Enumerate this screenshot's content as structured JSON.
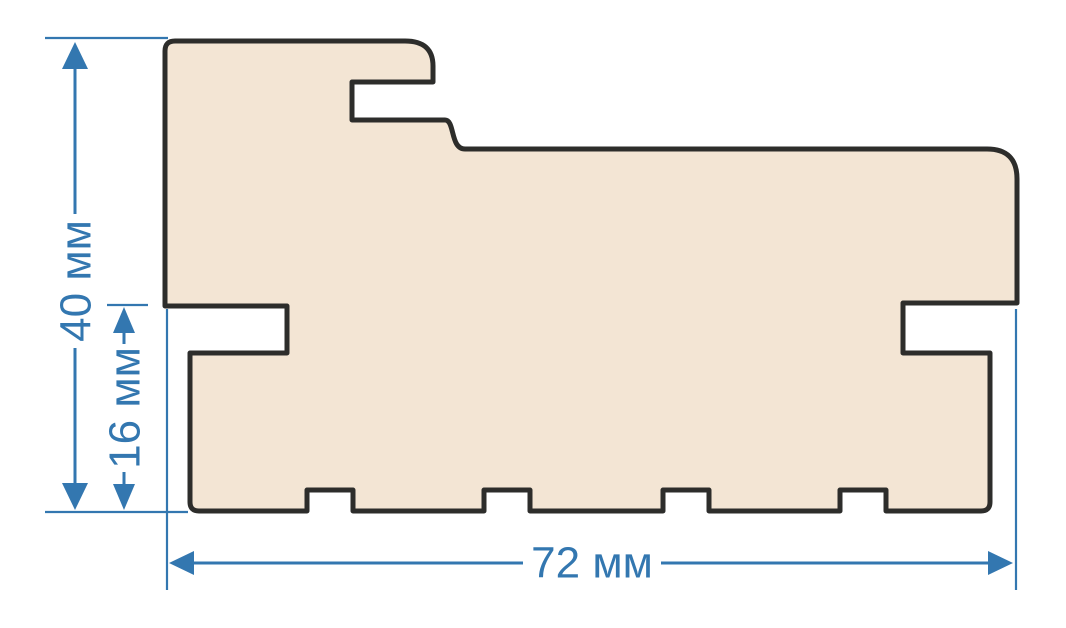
{
  "drawing": {
    "subject": "door-frame-profile-cross-section"
  },
  "dimensions": {
    "total_height": {
      "label": "40 мм",
      "value": 40,
      "unit": "мм",
      "orientation": "vertical"
    },
    "lower_height": {
      "label": "16 мм",
      "value": 16,
      "unit": "мм",
      "orientation": "vertical"
    },
    "total_width": {
      "label": "72 мм",
      "value": 72,
      "unit": "мм",
      "orientation": "horizontal"
    }
  },
  "colors": {
    "background": "#ffffff",
    "profile_fill": "#f3e5d4",
    "profile_outline": "#2d2d2b",
    "dimension": "#3377b0"
  }
}
